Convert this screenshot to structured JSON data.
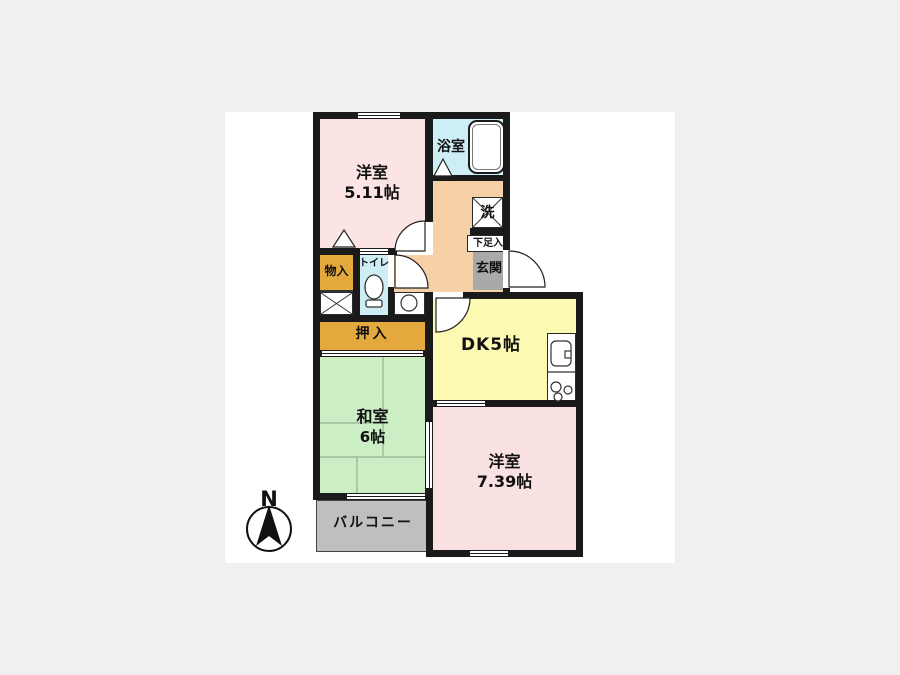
{
  "plan": {
    "rooms": {
      "western1": {
        "line1": "洋室",
        "line2": "5.11帖"
      },
      "bath": {
        "label": "浴室"
      },
      "laundry": {
        "label": "洗"
      },
      "shoe_storage": {
        "label": "下足入"
      },
      "entrance": {
        "label": "玄関"
      },
      "storage": {
        "label": "物入"
      },
      "toilet": {
        "label": "トイレ"
      },
      "closet": {
        "label": "押入"
      },
      "dk": {
        "label": "DK5帖"
      },
      "japanese": {
        "line1": "和室",
        "line2": "6帖"
      },
      "western2": {
        "line1": "洋室",
        "line2": "7.39帖"
      },
      "balcony": {
        "label": "バルコニー"
      }
    },
    "compass": {
      "label": "N"
    },
    "colors": {
      "background": "#f0f0f0",
      "paper": "#ffffff",
      "wall": "#1a1a1a",
      "western_room_pink": "#fbe4e3",
      "western_room2_pink": "#f9e1e1",
      "hallway_peach": "#f6d0a6",
      "bath_cyan": "#cdeef4",
      "dk_yellow": "#fcfab2",
      "japanese_green": "#cbeec4",
      "closet_orange": "#e5a83d",
      "entrance_gray": "#a9a9a9",
      "balcony_gray": "#bfbfbf"
    }
  }
}
